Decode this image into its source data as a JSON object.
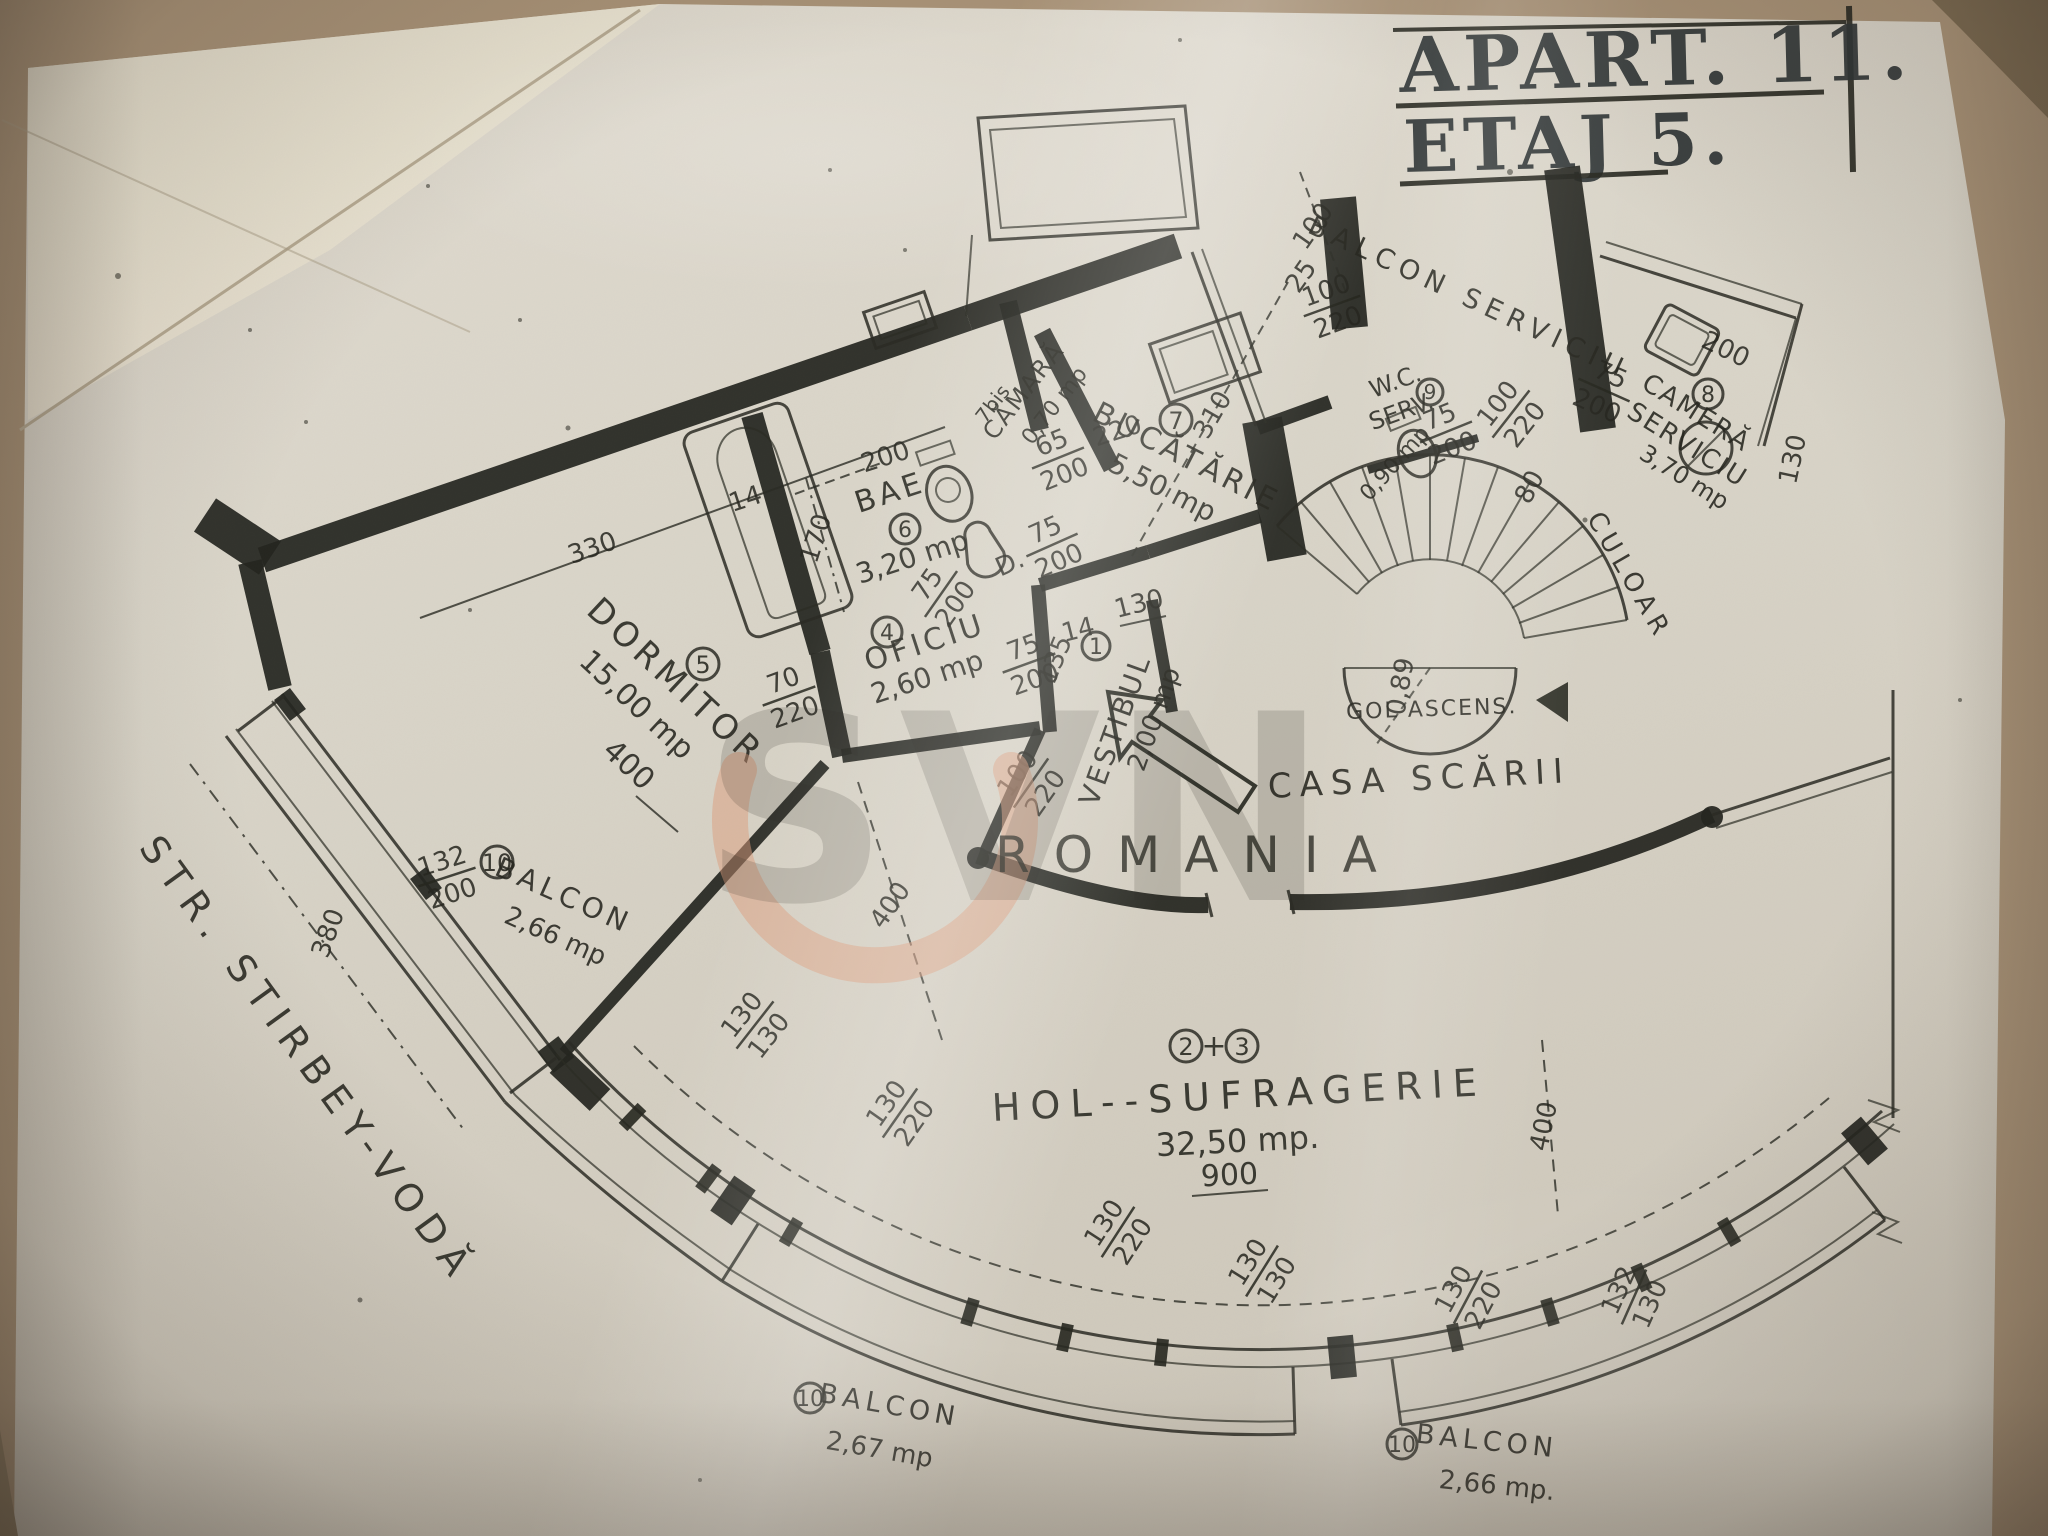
{
  "title": {
    "line1": "APART. 11.",
    "line2": "ETAJ 5."
  },
  "watermark": {
    "brand": "SVN",
    "country": "ROMANIA"
  },
  "street_label": "STR. STIRBEY-VODĂ",
  "rooms": {
    "vestibul": {
      "num": "1",
      "name": "VESTIBUL",
      "area": "2,00 mp"
    },
    "hol": {
      "num_a": "2",
      "plus": "+",
      "num_b": "3",
      "name": "HOL--SUFRAGERIE",
      "area": "32,50 mp.",
      "width": "900"
    },
    "oficiu": {
      "num": "4",
      "name": "OFICIU",
      "area": "2,60 mp"
    },
    "dormitor": {
      "num": "5",
      "name": "DORMITOR",
      "area": "15,00 mp",
      "width": "400"
    },
    "bae": {
      "num": "6",
      "name": "BAE",
      "area": "3,20 mp"
    },
    "bucatarie": {
      "num": "7",
      "name": "BUCĂTĂRIE",
      "area": "5,50 mp"
    },
    "camara": {
      "num": "7bis",
      "name": "CĂMARĂ",
      "area": "0,70 mp"
    },
    "camera_serviciu": {
      "num": "8",
      "line1": "CAMERĂ",
      "line2": "SERVICIU",
      "area": "3,70 mp"
    },
    "wc_serviciu": {
      "num": "9",
      "line1": "W.C.",
      "line2": "SERV.",
      "area": "0,90 mp"
    },
    "balcon_stanga": {
      "num": "10",
      "name": "BALCON",
      "area": "2,66 mp"
    },
    "balcon_mijloc": {
      "num": "10",
      "name": "BALCON",
      "area": "2,67 mp"
    },
    "balcon_dreapta": {
      "num": "10",
      "name": "BALCON",
      "area": "2,66 mp."
    },
    "balcon_serviciu": "BALCON  SERVICIU",
    "casa_scarii": "CASA SCĂRII",
    "gol_ascensor": "GOL ASCENS.",
    "culoar": "CULOAR"
  },
  "dims": {
    "balc_depth": "100",
    "balc_gap": "25",
    "balc_win": {
      "num": "100",
      "den": "220"
    },
    "balc_serv_door": {
      "num": "75",
      "den": "200"
    },
    "kitchen_len": "310",
    "kitchen_220": "220",
    "kitchen_door": {
      "prefix": "D.",
      "num": "75",
      "den": "200"
    },
    "camara_door": {
      "num": "65",
      "den": "200"
    },
    "bath_len": "200",
    "bath_tub": "170",
    "bath_wall": "14",
    "bath_door": {
      "num": "75",
      "den": "200"
    },
    "oficiu_door": {
      "num": "75",
      "den": "200"
    },
    "vest_135": "135",
    "vest_130": "130",
    "vest_wall": "14",
    "vest_door": {
      "num": "100",
      "den": "220"
    },
    "hall_depth": "400",
    "wc_door": {
      "num": "75",
      "den": "200"
    },
    "corridor_door": {
      "num": "100",
      "den": "220"
    },
    "corridor_80": "80",
    "cam_200": "200",
    "cam_130": "130",
    "dorm_len": "330",
    "dorm_door": {
      "num": "70",
      "den": "220"
    },
    "win_left": {
      "num": "132",
      "den": "200"
    },
    "left_len": "380",
    "fac1": {
      "num": "130",
      "den": "130"
    },
    "fac2": {
      "num": "130",
      "den": "220"
    },
    "fac3": {
      "num": "130",
      "den": "220"
    },
    "fac4": {
      "num": "130",
      "den": "130"
    },
    "fac5": {
      "num": "130",
      "den": "220"
    },
    "fac6": {
      "num": "132",
      "den": "130"
    },
    "right_depth": "400",
    "stair_r": "0,89"
  }
}
